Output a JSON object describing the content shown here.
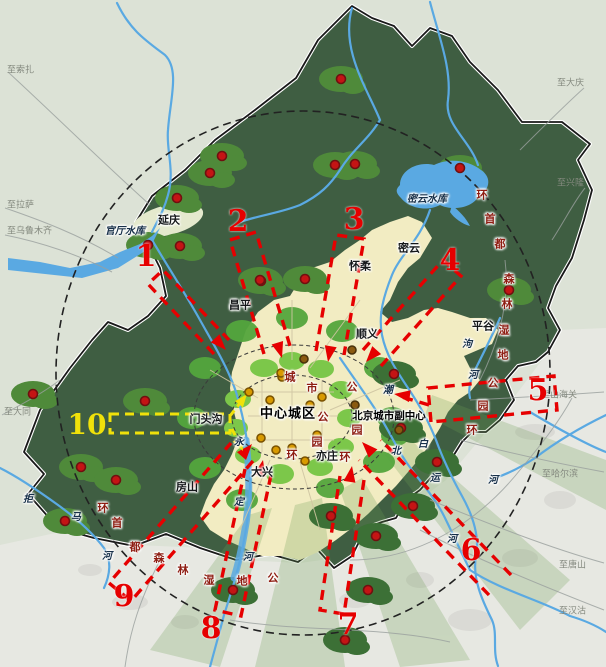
{
  "map": {
    "title_hint": "北京市域绿色空间与通风廊道示意图",
    "colors": {
      "outer_terrain": "#dce2d6",
      "lowland_se": "#e6e7e2",
      "mountain_green": "#3f5e42",
      "forest_patch": "#4f8a3a",
      "plain_yellow": "#f2ecc2",
      "park_green": "#7cc74a",
      "water_blue": "#5aa9e2",
      "corridor_red": "#e60000",
      "corridor_yellow": "#f0e10a",
      "ring_text": "#8e1d12"
    },
    "labels": [
      {
        "t": "延庆",
        "x": 169,
        "y": 220,
        "c": "district"
      },
      {
        "t": "昌平",
        "x": 240,
        "y": 305,
        "c": "district"
      },
      {
        "t": "怀柔",
        "x": 360,
        "y": 266,
        "c": "district"
      },
      {
        "t": "密云",
        "x": 409,
        "y": 248,
        "c": "district"
      },
      {
        "t": "顺义",
        "x": 367,
        "y": 334,
        "c": "district"
      },
      {
        "t": "平谷",
        "x": 483,
        "y": 326,
        "c": "district"
      },
      {
        "t": "门头沟",
        "x": 206,
        "y": 419,
        "c": "district"
      },
      {
        "t": "大兴",
        "x": 262,
        "y": 472,
        "c": "district"
      },
      {
        "t": "房山",
        "x": 187,
        "y": 487,
        "c": "district"
      },
      {
        "t": "亦庄",
        "x": 327,
        "y": 456,
        "c": "district"
      },
      {
        "t": "中心城区",
        "x": 288,
        "y": 414,
        "c": "core"
      },
      {
        "t": "北京城市副中心",
        "x": 389,
        "y": 416,
        "c": "subcenter"
      },
      {
        "t": "官厅水库",
        "x": 125,
        "y": 232,
        "c": "water"
      },
      {
        "t": "密云水库",
        "x": 427,
        "y": 200,
        "c": "water"
      },
      {
        "t": "潮",
        "x": 388,
        "y": 391,
        "c": "water"
      },
      {
        "t": "白",
        "x": 423,
        "y": 445,
        "c": "water"
      },
      {
        "t": "河",
        "x": 493,
        "y": 481,
        "c": "water"
      },
      {
        "t": "北",
        "x": 396,
        "y": 452,
        "c": "water"
      },
      {
        "t": "运",
        "x": 435,
        "y": 479,
        "c": "water"
      },
      {
        "t": "河",
        "x": 452,
        "y": 540,
        "c": "water"
      },
      {
        "t": "永",
        "x": 239,
        "y": 443,
        "c": "water"
      },
      {
        "t": "定",
        "x": 239,
        "y": 503,
        "c": "water"
      },
      {
        "t": "河",
        "x": 248,
        "y": 558,
        "c": "water"
      },
      {
        "t": "拒",
        "x": 28,
        "y": 500,
        "c": "water"
      },
      {
        "t": "马",
        "x": 76,
        "y": 518,
        "c": "water"
      },
      {
        "t": "河",
        "x": 107,
        "y": 557,
        "c": "water"
      },
      {
        "t": "泃",
        "x": 467,
        "y": 345,
        "c": "water"
      },
      {
        "t": "河",
        "x": 473,
        "y": 376,
        "c": "water"
      },
      {
        "t": "环",
        "x": 482,
        "y": 195,
        "c": "ringchar"
      },
      {
        "t": "首",
        "x": 490,
        "y": 219,
        "c": "ringchar"
      },
      {
        "t": "都",
        "x": 500,
        "y": 244,
        "c": "ringchar"
      },
      {
        "t": "森",
        "x": 509,
        "y": 279,
        "c": "ringchar"
      },
      {
        "t": "林",
        "x": 507,
        "y": 304,
        "c": "ringchar"
      },
      {
        "t": "湿",
        "x": 504,
        "y": 330,
        "c": "ringchar"
      },
      {
        "t": "地",
        "x": 503,
        "y": 355,
        "c": "ringchar"
      },
      {
        "t": "公",
        "x": 493,
        "y": 383,
        "c": "ringchar"
      },
      {
        "t": "园",
        "x": 483,
        "y": 406,
        "c": "ringchar"
      },
      {
        "t": "环",
        "x": 472,
        "y": 430,
        "c": "ringchar"
      },
      {
        "t": "环",
        "x": 103,
        "y": 508,
        "c": "ringchar"
      },
      {
        "t": "首",
        "x": 117,
        "y": 523,
        "c": "ringchar"
      },
      {
        "t": "都",
        "x": 135,
        "y": 547,
        "c": "ringchar"
      },
      {
        "t": "森",
        "x": 159,
        "y": 558,
        "c": "ringchar"
      },
      {
        "t": "林",
        "x": 183,
        "y": 570,
        "c": "ringchar"
      },
      {
        "t": "湿",
        "x": 209,
        "y": 580,
        "c": "ringchar"
      },
      {
        "t": "地",
        "x": 242,
        "y": 581,
        "c": "ringchar"
      },
      {
        "t": "公",
        "x": 273,
        "y": 578,
        "c": "ringchar"
      },
      {
        "t": "城",
        "x": 290,
        "y": 377,
        "c": "ringchar"
      },
      {
        "t": "市",
        "x": 312,
        "y": 388,
        "c": "ringchar"
      },
      {
        "t": "公",
        "x": 323,
        "y": 417,
        "c": "ringchar"
      },
      {
        "t": "园",
        "x": 317,
        "y": 442,
        "c": "ringchar"
      },
      {
        "t": "环",
        "x": 292,
        "y": 455,
        "c": "ringchar"
      },
      {
        "t": "公",
        "x": 352,
        "y": 387,
        "c": "ringchar"
      },
      {
        "t": "园",
        "x": 357,
        "y": 430,
        "c": "ringchar"
      },
      {
        "t": "环",
        "x": 345,
        "y": 457,
        "c": "ringchar"
      },
      {
        "t": "至索扎",
        "x": 7,
        "y": 71,
        "c": "dest",
        "anchor": "left"
      },
      {
        "t": "至拉萨",
        "x": 7,
        "y": 206,
        "c": "dest",
        "anchor": "left"
      },
      {
        "t": "至乌鲁木齐",
        "x": 7,
        "y": 232,
        "c": "dest",
        "anchor": "left"
      },
      {
        "t": "至大同",
        "x": 4,
        "y": 413,
        "c": "dest",
        "anchor": "left"
      },
      {
        "t": "至大庆",
        "x": 584,
        "y": 84,
        "c": "dest",
        "anchor": "right"
      },
      {
        "t": "至兴隆",
        "x": 584,
        "y": 184,
        "c": "dest",
        "anchor": "right"
      },
      {
        "t": "至山海关",
        "x": 577,
        "y": 396,
        "c": "dest",
        "anchor": "right"
      },
      {
        "t": "至哈尔滨",
        "x": 578,
        "y": 475,
        "c": "dest",
        "anchor": "right"
      },
      {
        "t": "至唐山",
        "x": 586,
        "y": 566,
        "c": "dest",
        "anchor": "right"
      },
      {
        "t": "至汉沽",
        "x": 586,
        "y": 612,
        "c": "dest",
        "anchor": "right"
      }
    ],
    "corridor_numbers": [
      {
        "t": "1",
        "x": 146,
        "y": 257,
        "c": "num-red"
      },
      {
        "t": "2",
        "x": 238,
        "y": 222,
        "c": "num-red"
      },
      {
        "t": "3",
        "x": 354,
        "y": 220,
        "c": "num-red"
      },
      {
        "t": "4",
        "x": 450,
        "y": 261,
        "c": "num-red"
      },
      {
        "t": "5",
        "x": 538,
        "y": 391,
        "c": "num-red"
      },
      {
        "t": "6",
        "x": 471,
        "y": 551,
        "c": "num-red"
      },
      {
        "t": "7",
        "x": 348,
        "y": 625,
        "c": "num-red"
      },
      {
        "t": "8",
        "x": 211,
        "y": 629,
        "c": "num-red"
      },
      {
        "t": "9",
        "x": 124,
        "y": 597,
        "c": "num-red"
      },
      {
        "t": "10",
        "x": 87,
        "y": 425,
        "c": "num-yellow"
      }
    ],
    "rings": {
      "capital_ring_name": "环首都森林湿地公园环",
      "city_park_ring_name": "城市公园环",
      "suburb_park_ring_name": "公园环"
    },
    "dots": {
      "red": [
        [
          222,
          156
        ],
        [
          210,
          173
        ],
        [
          177,
          198
        ],
        [
          148,
          245
        ],
        [
          180,
          246
        ],
        [
          261,
          281
        ],
        [
          341,
          79
        ],
        [
          335,
          165
        ],
        [
          355,
          164
        ],
        [
          460,
          168
        ],
        [
          509,
          290
        ],
        [
          260,
          280
        ],
        [
          305,
          279
        ],
        [
          33,
          394
        ],
        [
          145,
          401
        ],
        [
          81,
          467
        ],
        [
          116,
          480
        ],
        [
          65,
          521
        ],
        [
          233,
          590
        ],
        [
          394,
          374
        ],
        [
          401,
          428
        ],
        [
          437,
          462
        ],
        [
          413,
          506
        ],
        [
          331,
          516
        ],
        [
          376,
          536
        ],
        [
          368,
          590
        ],
        [
          345,
          640
        ]
      ],
      "amber": [
        [
          282,
          377
        ],
        [
          322,
          397
        ],
        [
          310,
          405
        ],
        [
          317,
          435
        ],
        [
          292,
          448
        ],
        [
          276,
          450
        ],
        [
          305,
          461
        ],
        [
          261,
          438
        ],
        [
          281,
          373
        ],
        [
          249,
          392
        ],
        [
          270,
          400
        ]
      ],
      "brown": [
        [
          304,
          359
        ],
        [
          355,
          405
        ],
        [
          352,
          350
        ],
        [
          399,
          430
        ]
      ]
    }
  }
}
